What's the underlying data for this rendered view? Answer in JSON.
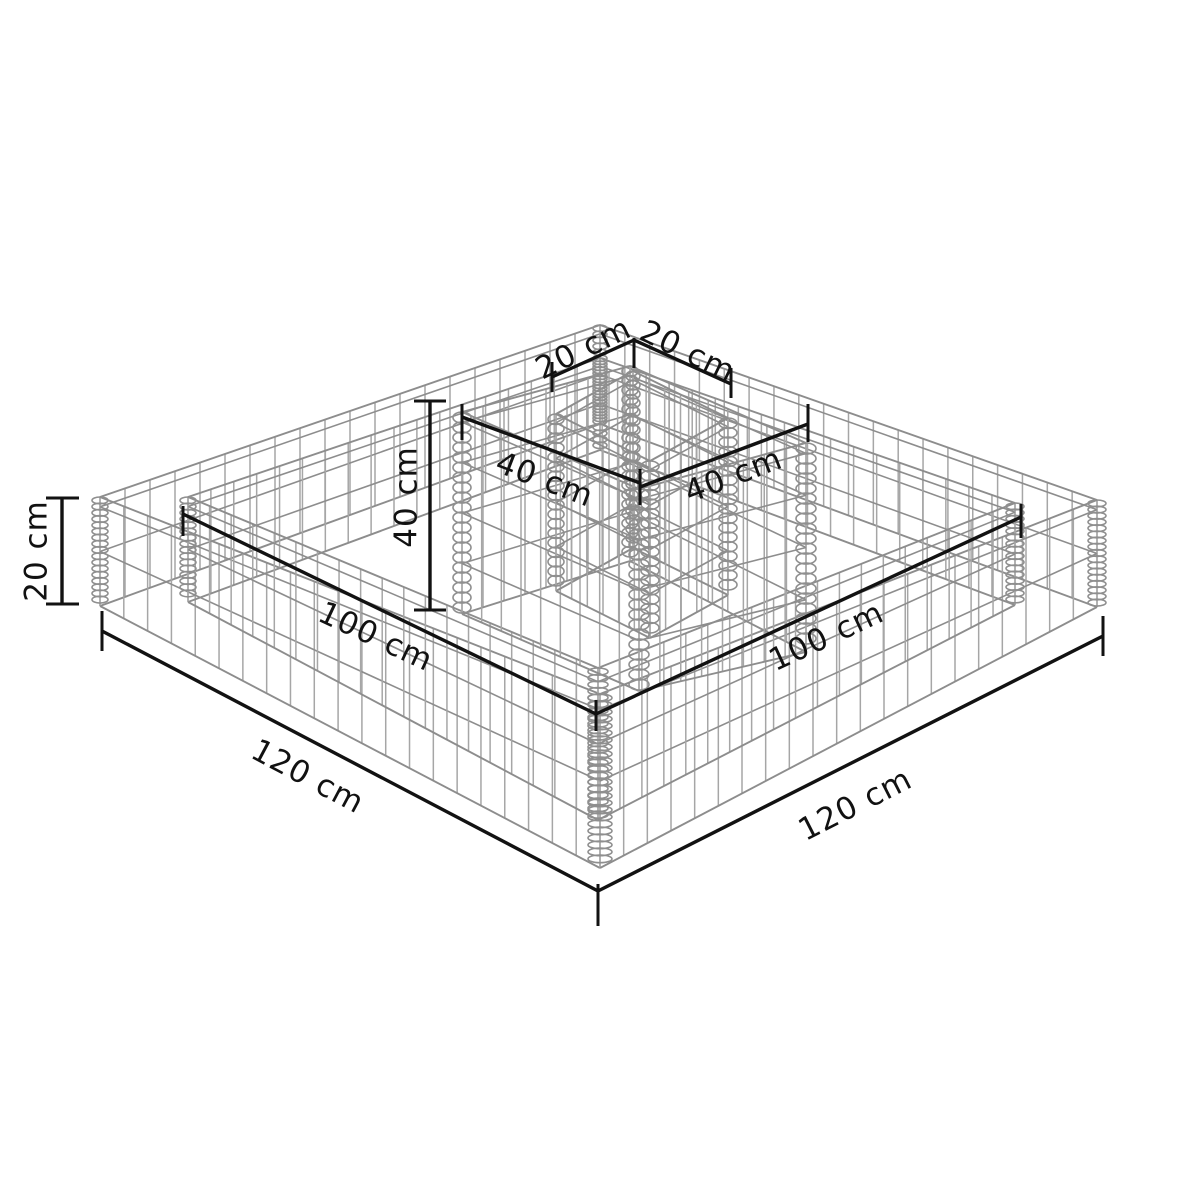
{
  "figure": {
    "background": "#ffffff",
    "colors": {
      "mesh": "#8d8d8d",
      "mesh_light": "#a6a6a6",
      "coil": "#8f8f8f",
      "dimension": "#121212",
      "label": "#111111"
    },
    "labels": {
      "outer_height": "20 cm",
      "tower_height": "40 cm",
      "tower_top_left": "20 cm",
      "tower_top_right": "20 cm",
      "tower_base_left": "40 cm",
      "tower_base_right": "40 cm",
      "inner_edge_left": "100 cm",
      "inner_edge_right": "100 cm",
      "outer_edge_left": "120 cm",
      "outer_edge_right": "120 cm"
    }
  }
}
